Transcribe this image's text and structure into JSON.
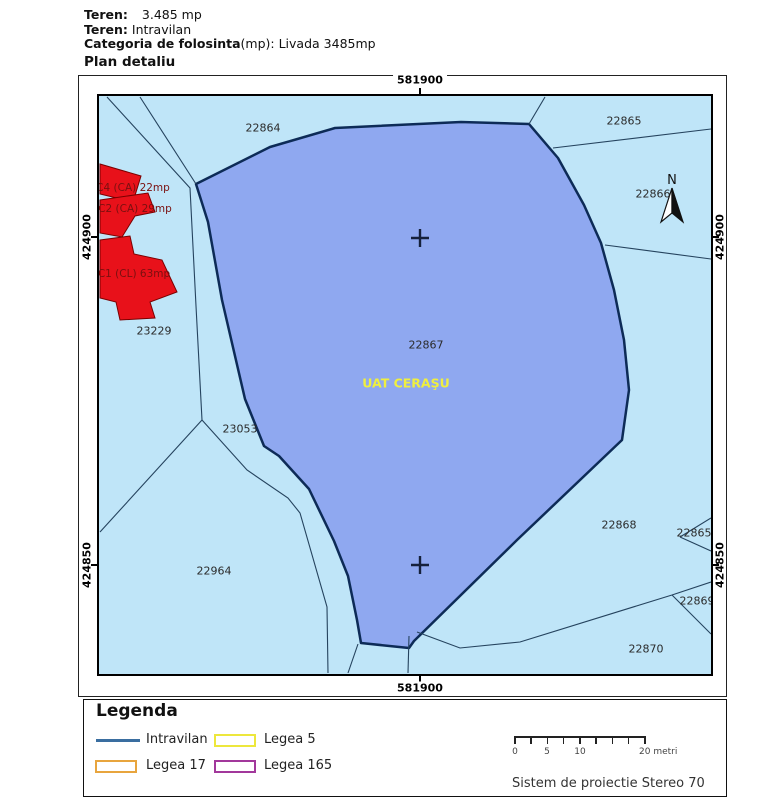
{
  "header": {
    "teren_label": "Teren:",
    "teren_value": "3.485 mp",
    "teren2_label": "Teren:",
    "teren2_value": "Intravilan",
    "categoria_label": "Categoria de folosinta",
    "categoria_value": "(mp): Livada 3485mp",
    "title": "Plan detaliu"
  },
  "map": {
    "grid_labels": {
      "top": "581900",
      "bottom": "581900",
      "left_upper": "424900",
      "left_lower": "424850",
      "right_upper": "424900",
      "right_lower": "424850"
    },
    "uat_label": "UAT CERAŞU",
    "north_label": "N",
    "parcels": [
      {
        "label": "22864"
      },
      {
        "label": "22865"
      },
      {
        "label": "22866"
      },
      {
        "label": "22867"
      },
      {
        "label": "22868"
      },
      {
        "label": "22865"
      },
      {
        "label": "22869"
      },
      {
        "label": "22870"
      },
      {
        "label": "23229"
      },
      {
        "label": "23053"
      },
      {
        "label": "22964"
      }
    ],
    "buildings": [
      {
        "label": "C4 (CA) 22mp"
      },
      {
        "label": "C2 (CA) 29mp"
      },
      {
        "label": "C1 (CL) 63mp"
      }
    ],
    "colors": {
      "background": "#BFE5F8",
      "uat_parcel_fill": "#8FA8F0",
      "uat_parcel_border": "#0D2B57",
      "building_fill": "#E8111A",
      "building_border": "#7A0000",
      "boundary_line": "#25435E",
      "uat_label_color": "#EFEF3F"
    }
  },
  "legend": {
    "title": "Legenda",
    "items": [
      {
        "label": "Intravilan",
        "swatch": "line",
        "color": "#3A6EA0"
      },
      {
        "label": "Legea 5",
        "swatch": "rect",
        "color": "#EDE73C"
      },
      {
        "label": "Legea 17",
        "swatch": "rect",
        "color": "#E8A53E"
      },
      {
        "label": "Legea 165",
        "swatch": "rect",
        "color": "#A2389B"
      }
    ],
    "scale": {
      "labels": [
        "0",
        "5",
        "10",
        "20 metri"
      ]
    },
    "projection": "Sistem de proiectie Stereo 70"
  }
}
